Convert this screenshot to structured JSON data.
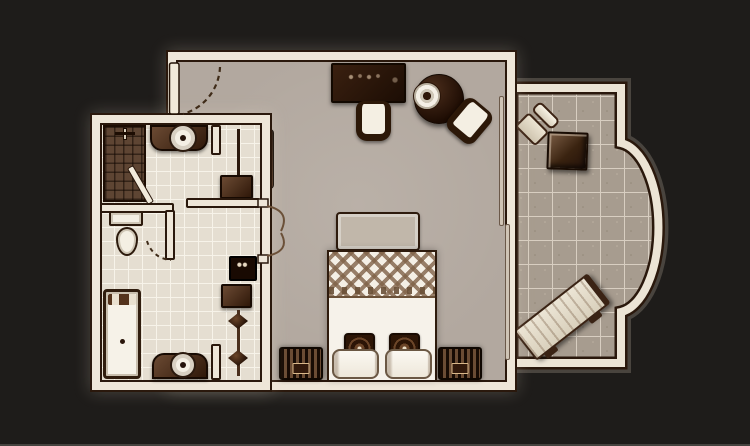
{
  "scene": {
    "type": "floor-plan",
    "subject": "hotel-guest-room-with-bathroom-and-balcony",
    "text_labels": []
  },
  "colors": {
    "bg": "#1e1c1a",
    "edge": "#45433f",
    "wall": "#eee6d8",
    "wall-dark": "#2a180c",
    "floor-bedroom": "#b2a89f",
    "floor-bath": "#e5ded1",
    "grout-bath": "#f7f3e9",
    "floor-balcony": "#a79c8f",
    "grout-balcony": "#d8cec1",
    "wood-dark": "#2f1809",
    "wood-mid": "#6b4a33",
    "shower": "#5e4533",
    "linen": "#f6f2ea",
    "bench": "#c1b7aa",
    "glow": "rgba(244,232,210,0.22)"
  },
  "rooms": {
    "bedroom": {
      "name": "bedroom",
      "furniture": [
        "entry-door",
        "desk",
        "desk-chair",
        "round-table",
        "table-tray",
        "dining-chair",
        "wall-mirror",
        "foot-bench",
        "double-bed",
        "accent-pillows",
        "white-pillows",
        "nightstand-left",
        "nightstand-right",
        "sliding-door-panels",
        "double-entry-doors-to-bathroom"
      ]
    },
    "bathroom": {
      "name": "bathroom",
      "furniture": [
        "shower",
        "shower-door",
        "vanity-sink-top",
        "closet-rod",
        "closet-shelf",
        "toilet",
        "toilet-compartment-walls",
        "bathtub",
        "vanity-sink-bottom",
        "tv-unit",
        "cabinet",
        "valet-rack"
      ]
    },
    "balcony": {
      "name": "balcony",
      "furniture": [
        "patio-chair",
        "side-table",
        "sun-lounger"
      ],
      "shape": "rectangle-with-semicircular-bay-on-right"
    }
  }
}
